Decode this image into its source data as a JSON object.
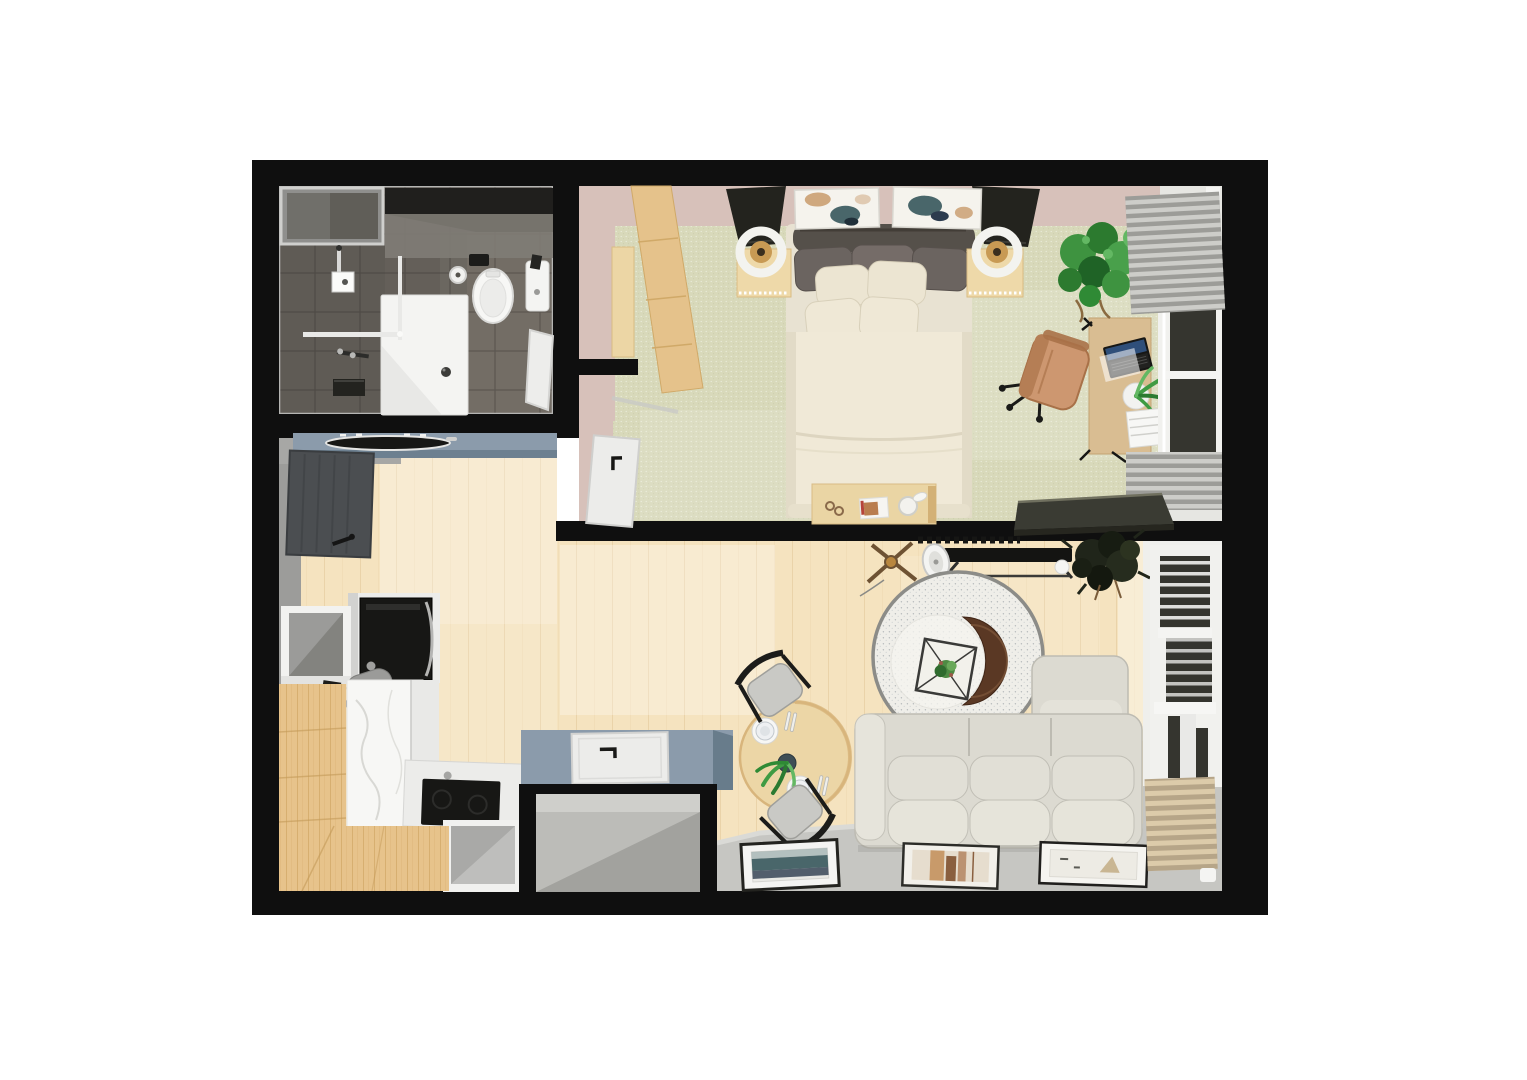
{
  "meta": {
    "title": "3D top-down floor plan render of a studio apartment",
    "view": "top-down 3D render",
    "background": "white canvas, no visible text"
  },
  "palette": {
    "bg": "#ffffff",
    "wall": "#0f0f0f",
    "bathFloor": "#645f59",
    "bathFloorLight": "#757067",
    "bathWallDark": "#201f1d",
    "bathNiche": "#8f8f8d",
    "bathNicheInner": "#706f6a",
    "tileLine": "#3f3c38",
    "fixtureWhite": "#f4f4f2",
    "glass": "#e9e9e7",
    "pinkWall": "#d7c1ba",
    "carpet": "#d8d9ba",
    "woodFloor": "#f5e3bf",
    "oak": "#e7c38b",
    "oakGrain": "#c49a58",
    "slate": "#8b9bab",
    "slateFront": "#6d8090",
    "slateDark": "#687c8b",
    "grayWall": "#9c9c9a",
    "cabinet": "#ececea",
    "cabinetShade": "#d2d2d0",
    "appliance": "#171715",
    "steel": "#9b9b99",
    "marble": "#f7f7f5",
    "marbleVein": "#d8d8d4",
    "storageFloor": "#bcbcb8",
    "storageShadow": "#a2a29e",
    "grayFloor": "#c6c6c2",
    "wallBandLight": "#efefec",
    "sofa": "#dcdad1",
    "sofaSeam": "#bdbbb2",
    "sofaLight": "#e6e4db",
    "rug": "#efeee9",
    "rugRim": "#8c8c88",
    "crescent": "#5a3824",
    "crescentHi": "#7a5438",
    "dining": "#ecd6a6",
    "diningRim": "#d8b57c",
    "chairSeat": "#c9c9c5",
    "chairFrame": "#1c1c1a",
    "duvet": "#f0e9d7",
    "pillow": "#ece5d2",
    "pillowDark": "#6b6460",
    "headboard": "#55504a",
    "lampShade": "#23231e",
    "lampAmber": "#c89a54",
    "nightstand": "#eed9a9",
    "benchWood": "#ead5a4",
    "artTeal": "#49666a",
    "artNavy": "#2c3b4e",
    "artTan": "#c89a6a",
    "plantGreen": "#3f9b43",
    "plantGreenDark": "#2b7a30",
    "plantGreenLight": "#63b863",
    "plantDarkFoliage": "#20251a",
    "chairTan": "#cd9770",
    "chairTanDark": "#a87148",
    "desk": "#d9bd92",
    "laptopScreen": "#2f4f7a",
    "doorDark": "#4b4e51",
    "doorWhite": "#ececea",
    "pane": "#35352f",
    "radiator": "#cdcdc9",
    "radiatorBase": "#9c9c98",
    "tanRad": "#dccbaa",
    "tanRadBase": "#b6a588",
    "consoleDark": "#3a3b33"
  },
  "rooms": [
    {
      "name": "Bathroom",
      "position": "top-left",
      "items": [
        "shower-tray",
        "shower-glass",
        "shower-head",
        "shower-mixer",
        "towel-shelf",
        "wall-niche",
        "toilet",
        "flush-plate",
        "toilet-paper-holder",
        "hand-sink",
        "bathroom-door"
      ]
    },
    {
      "name": "Bedroom",
      "position": "top-right",
      "items": [
        "double-bed",
        "headboard",
        "pillows",
        "duvet",
        "nightstand-left",
        "nightstand-right",
        "table-lamp-left",
        "table-lamp-right",
        "wall-art-left",
        "wall-art-right",
        "wardrobe",
        "bedroom-door",
        "foot-bench",
        "desk",
        "laptop",
        "office-chair",
        "desk-plant",
        "paper-stack",
        "potted-plant",
        "window",
        "radiator-upper",
        "radiator-lower",
        "side-console"
      ]
    },
    {
      "name": "Kitchen / Entry",
      "position": "left",
      "items": [
        "entry-door",
        "sink-counter",
        "trough-basin",
        "tall-cabinet",
        "oven",
        "open-cube-shelf",
        "faucet",
        "marble-counter",
        "oak-counter-left",
        "oak-counter-bottom",
        "cooktop",
        "corner-shelf",
        "storage-closet",
        "storage-door"
      ]
    },
    {
      "name": "Living / Dining",
      "position": "bottom-right",
      "items": [
        "dining-table",
        "dining-chair-top",
        "dining-chair-bottom",
        "dinner-plates",
        "table-plant",
        "sofa-with-chaise",
        "round-rug",
        "crescent-coffee-table",
        "glass-tray-plant",
        "tv",
        "media-vent",
        "speaker-disc",
        "tripod-floor-lamp",
        "dark-floor-plant",
        "framed-art-teal",
        "framed-art-tan",
        "framed-art-pale",
        "window-stack",
        "window-blinds",
        "tan-radiator"
      ]
    }
  ]
}
